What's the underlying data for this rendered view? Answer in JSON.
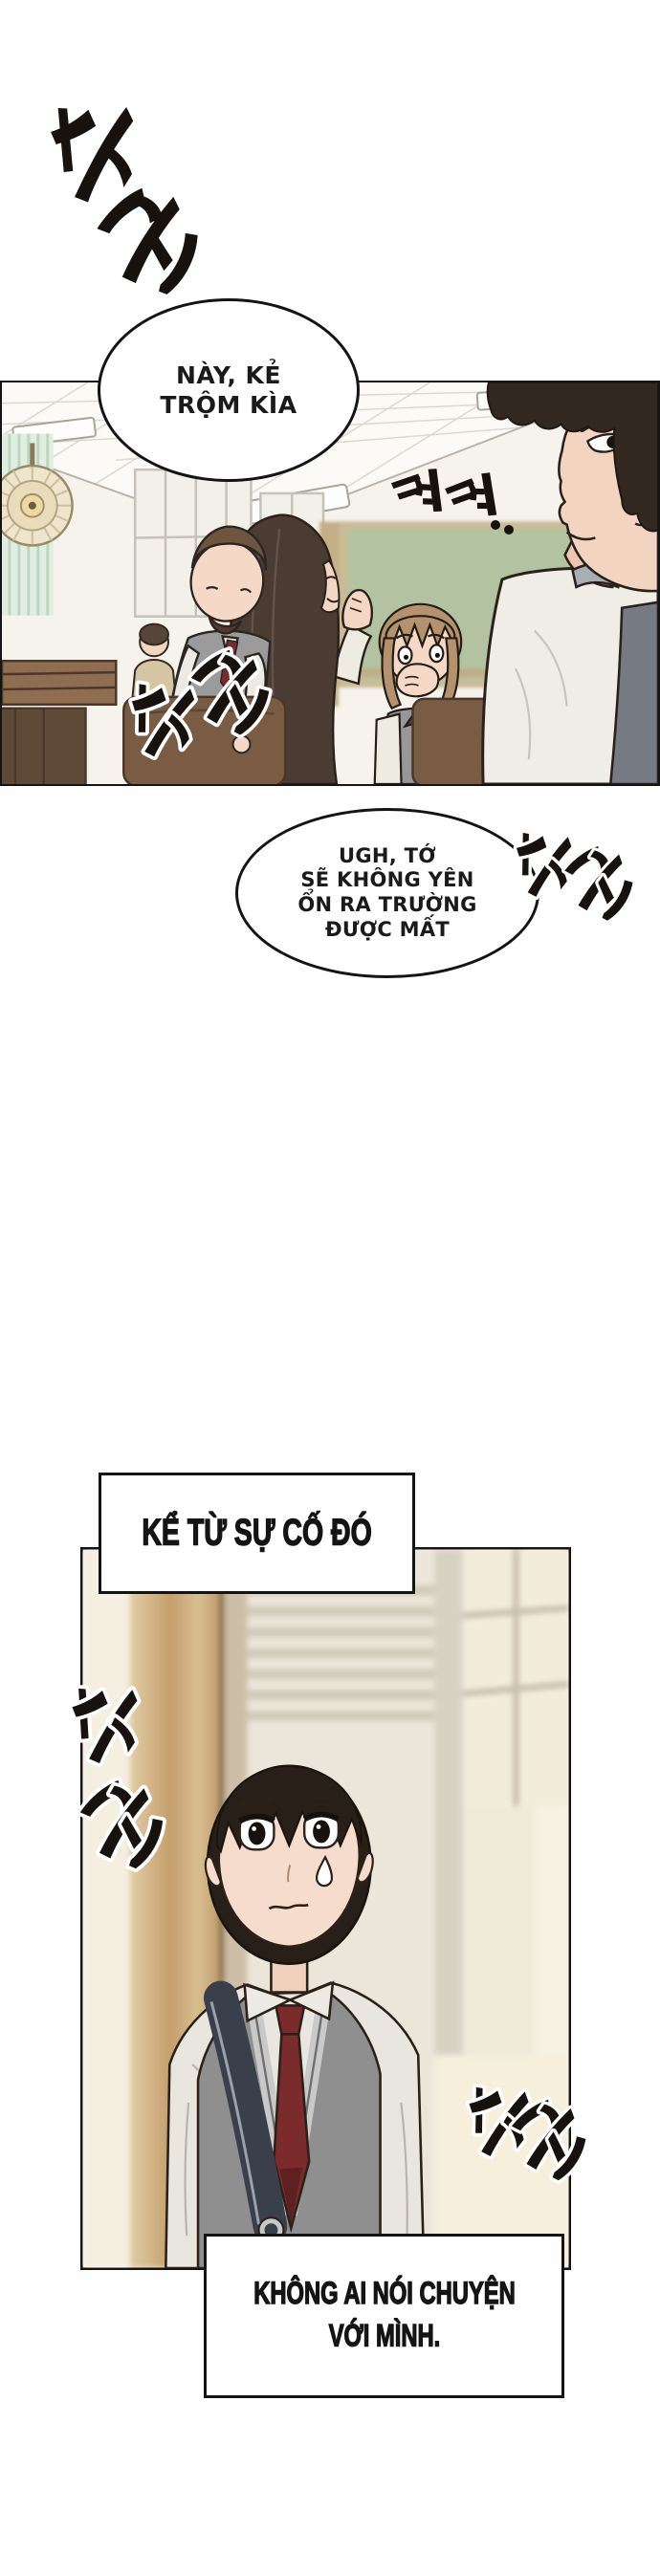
{
  "page": {
    "kind": "webtoon-comic-page",
    "bg": "#ffffff"
  },
  "speech": {
    "bubble1": {
      "lines": [
        "NÀY, KẺ",
        "TRỘM KÌA"
      ]
    },
    "bubble2": {
      "lines": [
        "UGH, TỚ",
        "SẼ KHÔNG YÊN",
        "ỔN RA TRƯỜNG",
        "ĐƯỢC MẤT"
      ]
    }
  },
  "captions": {
    "caption1": {
      "text": "KỂ TỪ SỰ CỐ ĐÓ"
    },
    "caption2": {
      "lines": [
        "KHÔNG AI NÓI CHUYỆN",
        "VỚI MÌNH."
      ]
    }
  },
  "sfx": {
    "whisper": {
      "label": "수군",
      "meaning": "whisper-whisper"
    },
    "snicker": {
      "label": "캬캬..",
      "meaning": "snicker"
    }
  },
  "scene": {
    "panel1": {
      "alt": "classroom-students-whispering"
    },
    "panel2": {
      "alt": "boy-standing-alone-worried"
    }
  },
  "colors": {
    "panel_border": "#141414",
    "vest_gray": "#8f8f8f",
    "tie_red": "#7b2b2b",
    "chalkboard_green": "#b3c2a0",
    "wood_tan": "#c49e6b",
    "skin": "#f5dbc9",
    "hair_dark": "#281f18"
  }
}
